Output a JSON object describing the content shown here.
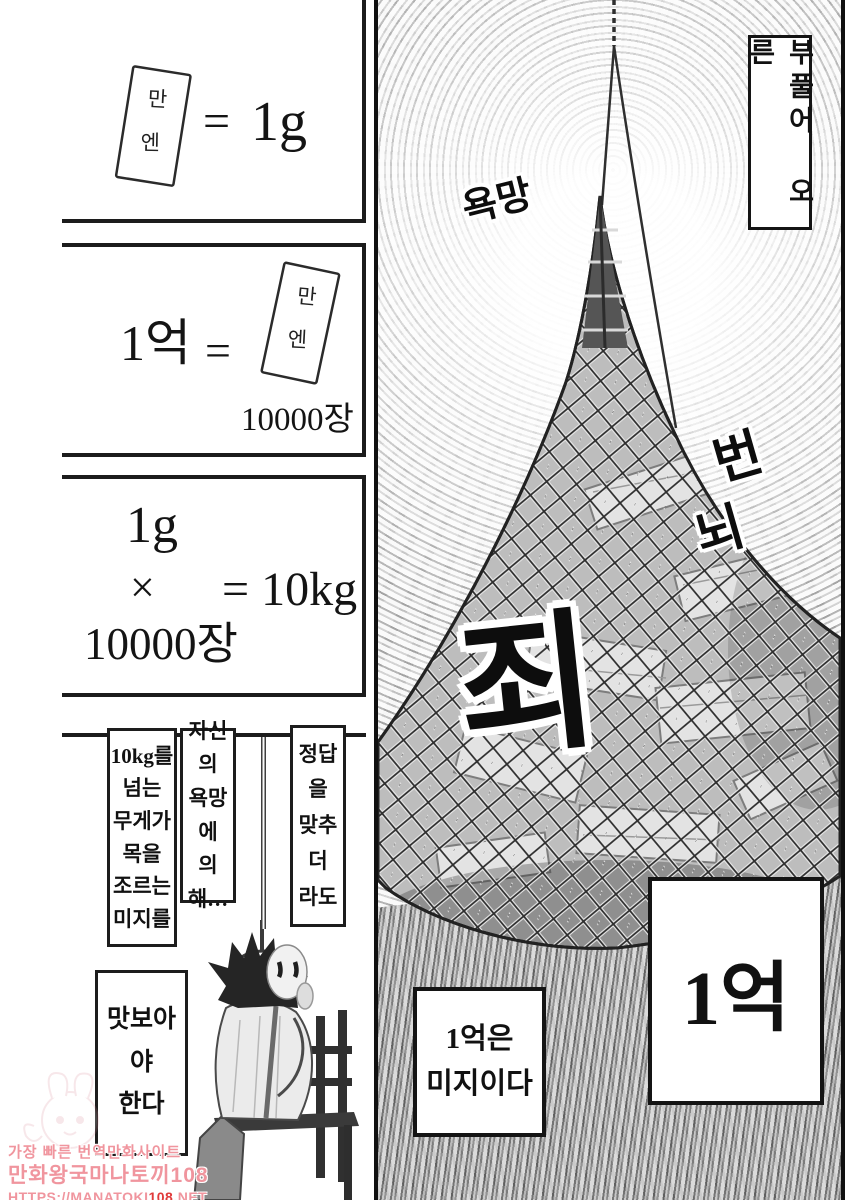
{
  "colors": {
    "ink": "#1a1a1a",
    "watermark_pink": "#f0959e",
    "watermark_red": "#e03a3a"
  },
  "left_column": {
    "panel1": {
      "note_char_top": "만",
      "note_char_bottom": "엔",
      "equals": "=",
      "result": "1g"
    },
    "panel2": {
      "amount": "1억",
      "equals": "=",
      "note_char_top": "만",
      "note_char_bottom": "엔",
      "count": "10000장"
    },
    "panel3": {
      "operand_top": "1g",
      "operator": "×",
      "result": "= 10kg",
      "operand_bottom": "10000장"
    },
    "panel4": {
      "caption_left_lines": [
        "10kg를",
        "넘는",
        "무게가",
        "목을",
        "조르는",
        "미지를"
      ],
      "caption_mid_lines": [
        "자신의",
        "욕망에",
        "의해…"
      ],
      "caption_right_lines": [
        "정답을",
        "맞추더",
        "라도"
      ],
      "caption_bottom_lines": [
        "맛보아야",
        "한다"
      ]
    }
  },
  "right_panel": {
    "caption_top": "부풀어 오른",
    "sfx_desire": "욕망",
    "sfx_burden_char1": "번",
    "sfx_burden_char2": "뇌",
    "sfx_sin": "죄",
    "amount_box": "1억",
    "mystery_lines": [
      "1억은",
      "미지이다"
    ]
  },
  "watermark": {
    "line1": "가장 빠른 번역만화사이트",
    "line2": "만화왕국마나토끼108",
    "line3_prefix": "HTTPS://MANATOKI",
    "line3_highlight": "108",
    "line3_suffix": ".NET"
  }
}
